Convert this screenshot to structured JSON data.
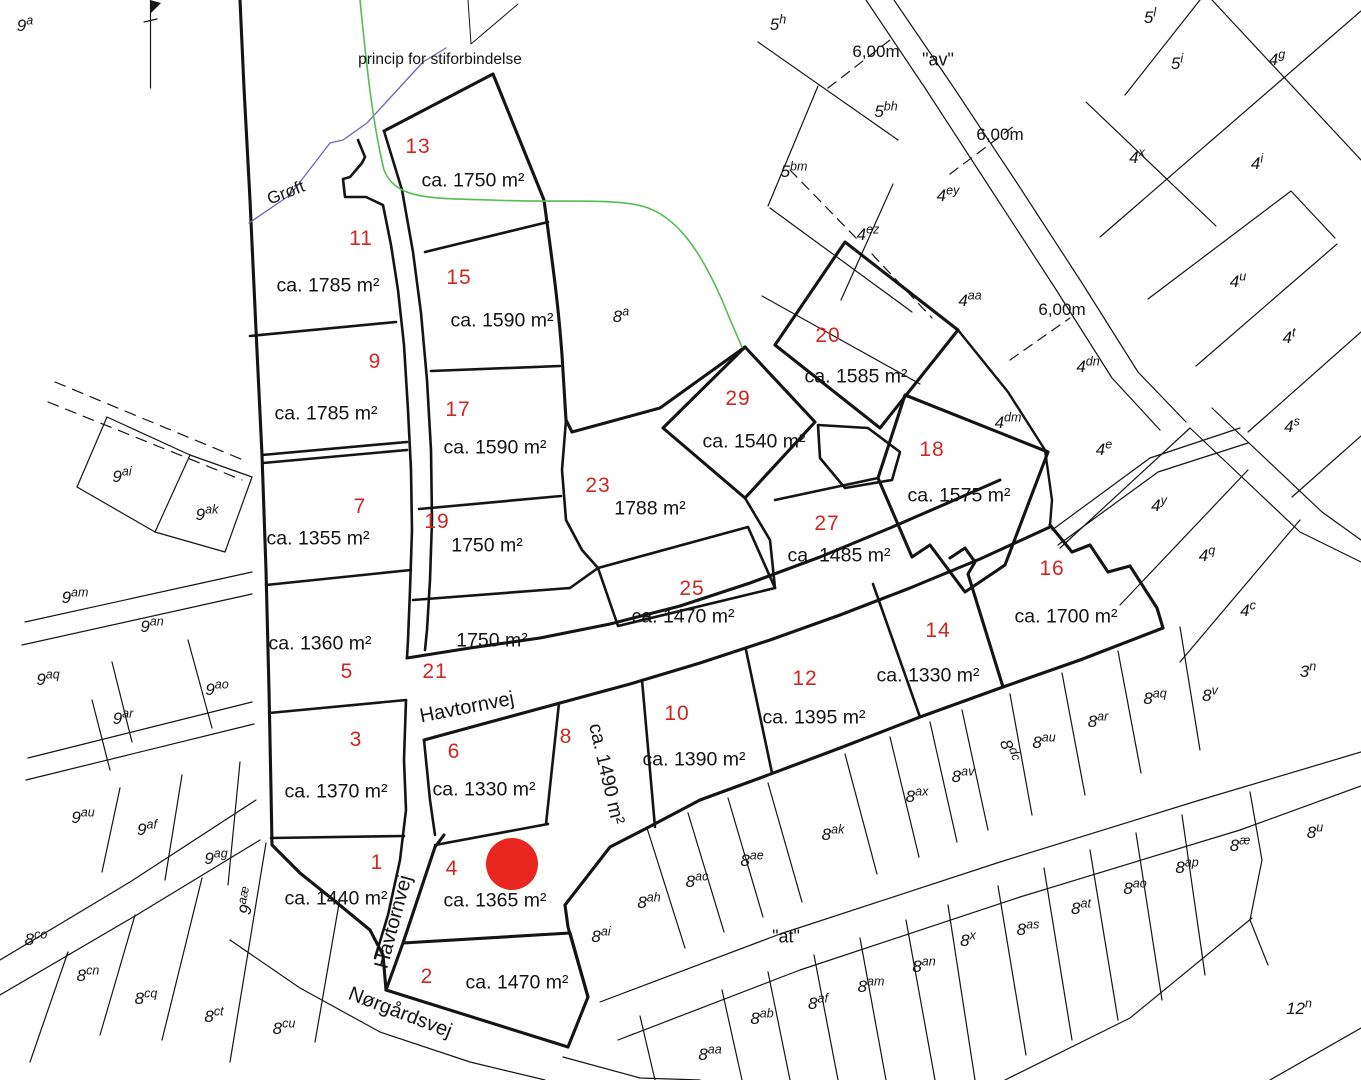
{
  "map": {
    "title_note": "princip for stiforbindelse",
    "ditch_label": "Grøft",
    "marker": {
      "x": 512,
      "y": 864,
      "r": 26,
      "color": "#e8251f"
    },
    "colors": {
      "plot_number": "#cf2822",
      "line": "#141414",
      "path_green": "#55bb55",
      "ditch_blue": "#6868b8",
      "background": "#ffffff"
    },
    "plots": [
      {
        "no": "1",
        "area": "ca. 1440 m²",
        "no_pos": [
          377,
          863
        ],
        "area_pos": [
          336,
          899
        ]
      },
      {
        "no": "2",
        "area": "ca. 1470 m²",
        "no_pos": [
          427,
          977
        ],
        "area_pos": [
          517,
          983
        ]
      },
      {
        "no": "3",
        "area": "ca. 1370 m²",
        "no_pos": [
          356,
          740
        ],
        "area_pos": [
          336,
          792
        ]
      },
      {
        "no": "4",
        "area": "ca. 1365 m²",
        "no_pos": [
          452,
          869
        ],
        "area_pos": [
          495,
          901
        ]
      },
      {
        "no": "5",
        "area": "ca. 1360 m²",
        "no_pos": [
          347,
          672
        ],
        "area_pos": [
          320,
          644
        ]
      },
      {
        "no": "6",
        "area": "ca. 1330 m²",
        "no_pos": [
          454,
          752
        ],
        "area_pos": [
          484,
          790
        ]
      },
      {
        "no": "7",
        "area": "ca. 1355 m²",
        "no_pos": [
          360,
          507
        ],
        "area_pos": [
          318,
          539
        ]
      },
      {
        "no": "8",
        "area": "ca. 1490 m²",
        "no_pos": [
          566,
          737
        ],
        "area_pos": [
          606,
          774
        ],
        "area_rot": 77
      },
      {
        "no": "9",
        "area": "ca. 1785 m²",
        "no_pos": [
          375,
          362
        ],
        "area_pos": [
          326,
          414
        ]
      },
      {
        "no": "10",
        "area": "ca. 1390 m²",
        "no_pos": [
          677,
          714
        ],
        "area_pos": [
          694,
          760
        ]
      },
      {
        "no": "11",
        "area": "ca. 1785 m²",
        "no_pos": [
          361,
          239
        ],
        "area_pos": [
          328,
          286
        ]
      },
      {
        "no": "12",
        "area": "ca. 1395 m²",
        "no_pos": [
          805,
          679
        ],
        "area_pos": [
          814,
          718
        ]
      },
      {
        "no": "13",
        "area": "ca. 1750 m²",
        "no_pos": [
          418,
          147
        ],
        "area_pos": [
          473,
          181
        ]
      },
      {
        "no": "14",
        "area": "ca. 1330 m²",
        "no_pos": [
          938,
          631
        ],
        "area_pos": [
          928,
          676
        ]
      },
      {
        "no": "15",
        "area": "ca. 1590 m²",
        "no_pos": [
          459,
          278
        ],
        "area_pos": [
          502,
          321
        ]
      },
      {
        "no": "16",
        "area": "ca. 1700 m²",
        "no_pos": [
          1052,
          569
        ],
        "area_pos": [
          1066,
          617
        ]
      },
      {
        "no": "17",
        "area": "ca. 1590 m²",
        "no_pos": [
          458,
          410
        ],
        "area_pos": [
          495,
          448
        ]
      },
      {
        "no": "18",
        "area": "ca. 1575 m²",
        "no_pos": [
          932,
          450
        ],
        "area_pos": [
          959,
          496
        ]
      },
      {
        "no": "19",
        "area": "1750 m²",
        "no_pos": [
          437,
          522
        ],
        "area_pos": [
          487,
          546
        ]
      },
      {
        "no": "20",
        "area": "ca. 1585 m²",
        "no_pos": [
          828,
          336
        ],
        "area_pos": [
          856,
          377
        ]
      },
      {
        "no": "21",
        "area": "1750 m²",
        "no_pos": [
          435,
          672
        ],
        "area_pos": [
          492,
          641
        ]
      },
      {
        "no": "23",
        "area": "1788 m²",
        "no_pos": [
          598,
          486
        ],
        "area_pos": [
          650,
          509
        ]
      },
      {
        "no": "25",
        "area": "ca. 1470 m²",
        "no_pos": [
          692,
          589
        ],
        "area_pos": [
          683,
          617
        ]
      },
      {
        "no": "27",
        "area": "ca. 1485 m²",
        "no_pos": [
          827,
          524
        ],
        "area_pos": [
          839,
          556
        ]
      },
      {
        "no": "29",
        "area": "ca. 1540 m²",
        "no_pos": [
          738,
          399
        ],
        "area_pos": [
          754,
          442
        ]
      }
    ],
    "cadastral": [
      {
        "b": "9",
        "s": "a",
        "pos": [
          25,
          26
        ]
      },
      {
        "b": "5",
        "s": "h",
        "pos": [
          778,
          25
        ]
      },
      {
        "b": "5",
        "s": "l",
        "pos": [
          1150,
          18
        ]
      },
      {
        "b": "5",
        "s": "i",
        "pos": [
          1177,
          64
        ]
      },
      {
        "b": "4",
        "s": "g",
        "pos": [
          1277,
          60
        ]
      },
      {
        "b": "5",
        "s": "bh",
        "pos": [
          886,
          112
        ]
      },
      {
        "b": "5",
        "s": "bm",
        "pos": [
          794,
          172
        ]
      },
      {
        "b": "4",
        "s": "ey",
        "pos": [
          948,
          196
        ]
      },
      {
        "b": "4",
        "s": "ez",
        "pos": [
          868,
          235
        ]
      },
      {
        "b": "4",
        "s": "x",
        "pos": [
          1137,
          158
        ]
      },
      {
        "b": "4",
        "s": "i",
        "pos": [
          1257,
          164
        ]
      },
      {
        "b": "4",
        "s": "aa",
        "pos": [
          970,
          301
        ]
      },
      {
        "b": "4",
        "s": "dn",
        "pos": [
          1088,
          367
        ]
      },
      {
        "b": "4",
        "s": "u",
        "pos": [
          1238,
          282
        ]
      },
      {
        "b": "4",
        "s": "t",
        "pos": [
          1289,
          338
        ]
      },
      {
        "b": "4",
        "s": "dm",
        "pos": [
          1008,
          423
        ]
      },
      {
        "b": "4",
        "s": "s",
        "pos": [
          1292,
          427
        ]
      },
      {
        "b": "4",
        "s": "e",
        "pos": [
          1104,
          450
        ]
      },
      {
        "b": "4",
        "s": "y",
        "pos": [
          1159,
          506
        ]
      },
      {
        "b": "4",
        "s": "q",
        "pos": [
          1207,
          556
        ]
      },
      {
        "b": "4",
        "s": "c",
        "pos": [
          1248,
          611
        ]
      },
      {
        "b": "3",
        "s": "n",
        "pos": [
          1308,
          672
        ]
      },
      {
        "b": "8",
        "s": "a",
        "pos": [
          621,
          317
        ]
      },
      {
        "b": "9",
        "s": "ai",
        "pos": [
          122,
          477
        ]
      },
      {
        "b": "9",
        "s": "ak",
        "pos": [
          207,
          515
        ]
      },
      {
        "b": "9",
        "s": "am",
        "pos": [
          75,
          598
        ]
      },
      {
        "b": "9",
        "s": "an",
        "pos": [
          152,
          627
        ]
      },
      {
        "b": "9",
        "s": "aq",
        "pos": [
          48,
          680
        ]
      },
      {
        "b": "9",
        "s": "ao",
        "pos": [
          217,
          690
        ]
      },
      {
        "b": "9",
        "s": "ar",
        "pos": [
          123,
          719
        ]
      },
      {
        "b": "9",
        "s": "au",
        "pos": [
          83,
          818
        ]
      },
      {
        "b": "9",
        "s": "af",
        "pos": [
          147,
          830
        ]
      },
      {
        "b": "9",
        "s": "ag",
        "pos": [
          216,
          859
        ]
      },
      {
        "b": "9",
        "s": "aæ",
        "pos": [
          248,
          901
        ],
        "rot": -78
      },
      {
        "b": "8",
        "s": "co",
        "pos": [
          36,
          940
        ]
      },
      {
        "b": "8",
        "s": "cn",
        "pos": [
          88,
          976
        ]
      },
      {
        "b": "8",
        "s": "cq",
        "pos": [
          146,
          999
        ]
      },
      {
        "b": "8",
        "s": "ct",
        "pos": [
          214,
          1017
        ]
      },
      {
        "b": "8",
        "s": "cu",
        "pos": [
          284,
          1029
        ]
      },
      {
        "b": "8",
        "s": "dc",
        "pos": [
          1008,
          751
        ],
        "rot": 72
      },
      {
        "b": "8",
        "s": "au",
        "pos": [
          1044,
          743
        ]
      },
      {
        "b": "8",
        "s": "av",
        "pos": [
          963,
          777
        ]
      },
      {
        "b": "8",
        "s": "ax",
        "pos": [
          917,
          797
        ]
      },
      {
        "b": "8",
        "s": "ak",
        "pos": [
          833,
          835
        ]
      },
      {
        "b": "8",
        "s": "ae",
        "pos": [
          752,
          861
        ]
      },
      {
        "b": "8",
        "s": "ac",
        "pos": [
          697,
          882
        ]
      },
      {
        "b": "8",
        "s": "ah",
        "pos": [
          649,
          903
        ]
      },
      {
        "b": "8",
        "s": "ai",
        "pos": [
          601,
          937
        ]
      },
      {
        "b": "8",
        "s": "aq",
        "pos": [
          1155,
          699
        ]
      },
      {
        "b": "8",
        "s": "ar",
        "pos": [
          1098,
          722
        ]
      },
      {
        "b": "8",
        "s": "v",
        "pos": [
          1210,
          696
        ]
      },
      {
        "b": "8",
        "s": "aa",
        "pos": [
          710,
          1055
        ]
      },
      {
        "b": "8",
        "s": "ab",
        "pos": [
          762,
          1019
        ]
      },
      {
        "b": "8",
        "s": "af",
        "pos": [
          818,
          1004
        ]
      },
      {
        "b": "8",
        "s": "am",
        "pos": [
          871,
          987
        ]
      },
      {
        "b": "8",
        "s": "an",
        "pos": [
          924,
          967
        ]
      },
      {
        "b": "8",
        "s": "x",
        "pos": [
          968,
          941
        ]
      },
      {
        "b": "8",
        "s": "as",
        "pos": [
          1028,
          930
        ]
      },
      {
        "b": "8",
        "s": "at",
        "pos": [
          1081,
          909
        ]
      },
      {
        "b": "8",
        "s": "ao",
        "pos": [
          1135,
          889
        ]
      },
      {
        "b": "8",
        "s": "ap",
        "pos": [
          1187,
          868
        ]
      },
      {
        "b": "8",
        "s": "æ",
        "pos": [
          1240,
          846
        ]
      },
      {
        "b": "8",
        "s": "u",
        "pos": [
          1315,
          833
        ]
      },
      {
        "b": "12",
        "s": "n",
        "pos": [
          1299,
          1009
        ]
      }
    ],
    "streets": [
      {
        "name": "Havtornvej",
        "pos": [
          467,
          708
        ],
        "rot": -11
      },
      {
        "name": "Havtornvej",
        "pos": [
          394,
          922
        ],
        "rot": -75
      },
      {
        "name": "Nørgårdsvej",
        "pos": [
          400,
          1013
        ],
        "rot": 21
      }
    ],
    "quoted_names": [
      {
        "text": "\"av\"",
        "pos": [
          938,
          60
        ]
      },
      {
        "text": "\"at\"",
        "pos": [
          786,
          937
        ]
      }
    ],
    "measurements": [
      {
        "text": "6,00m",
        "pos": [
          876,
          52
        ]
      },
      {
        "text": "6,00m",
        "pos": [
          1000,
          135
        ]
      },
      {
        "text": "6,00m",
        "pos": [
          1062,
          310
        ]
      }
    ],
    "notes": [
      {
        "text": "princip for stiforbindelse",
        "pos": [
          440,
          60
        ]
      },
      {
        "text": "Grøft",
        "pos": [
          286,
          193
        ],
        "rot": -21
      }
    ]
  }
}
